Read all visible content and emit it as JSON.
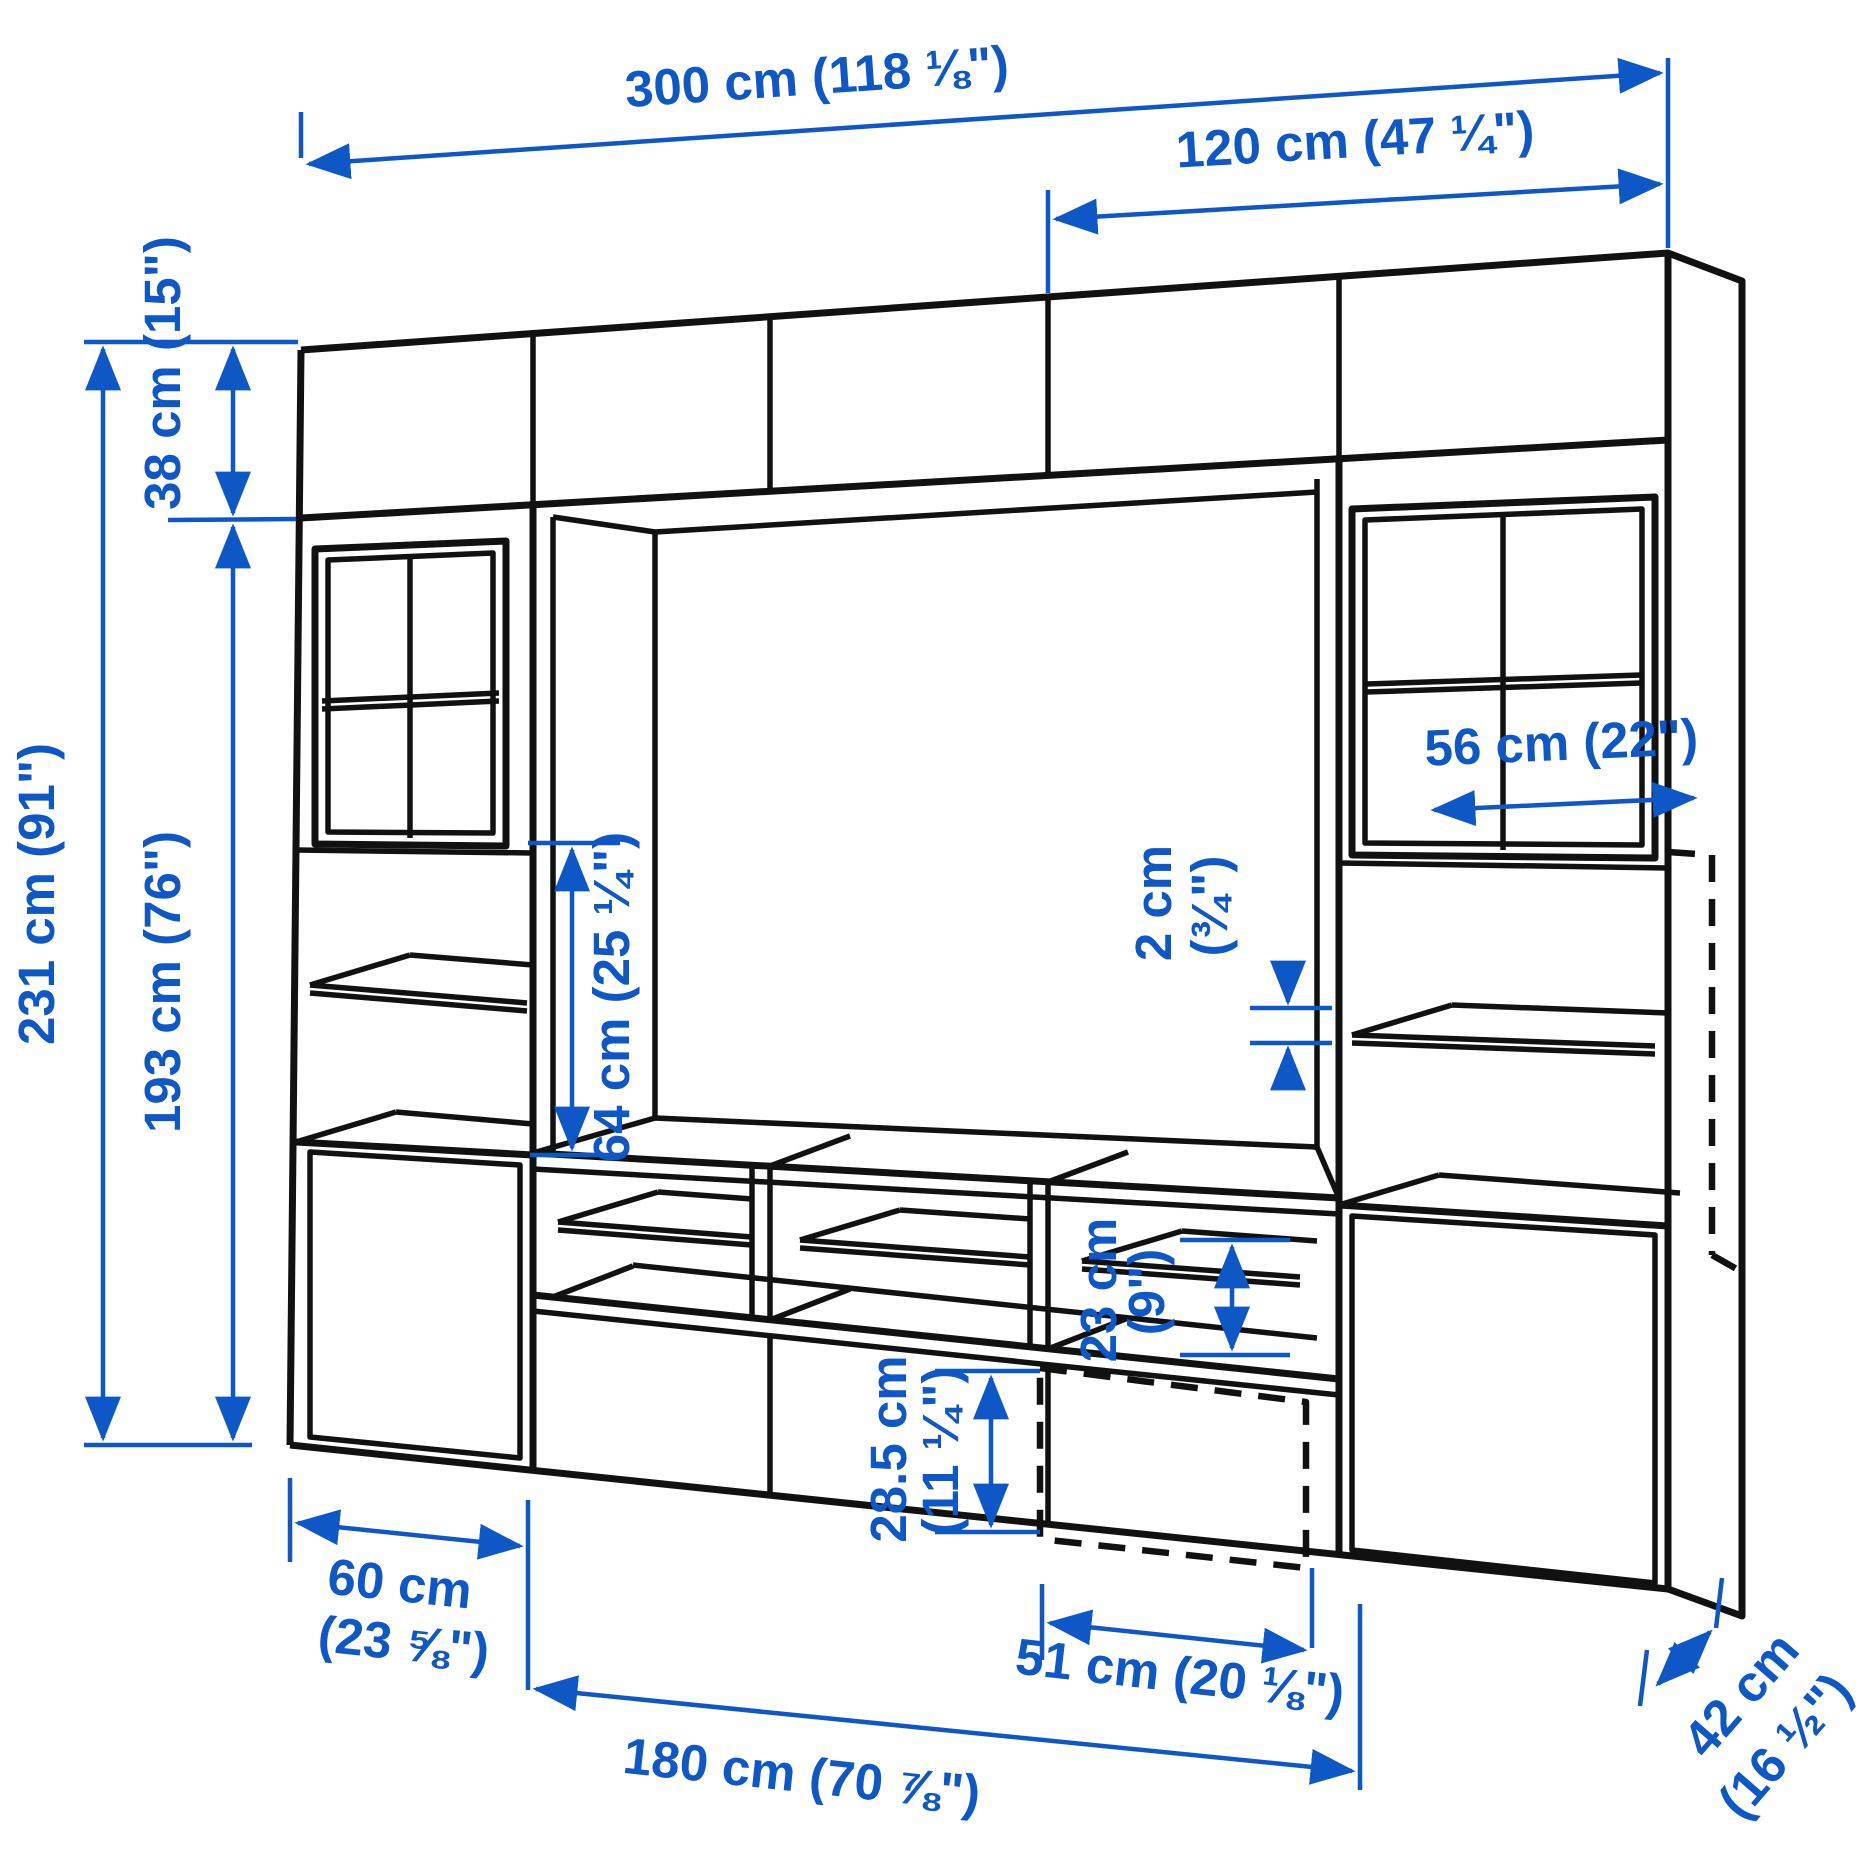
{
  "diagram": {
    "type": "furniture-dimension-diagram",
    "subject": "TV storage combination wall unit with glass doors and drawers",
    "line_color": "#111111",
    "accent_color": "#0e57c7",
    "labels": {
      "overall_width": "300 cm (118 ⅛\")",
      "upper_right_width": "120 cm (47 ¼\")",
      "top_cabinet_height": "38 cm (15\")",
      "total_height": "231 cm (91\")",
      "column_height": "193 cm (76\")",
      "tv_opening_height": "64 cm (25 ¼\")",
      "interior_width": "56 cm (22\")",
      "shelf_thickness_cm": "2 cm",
      "shelf_thickness_in": "(¾\")",
      "shelf_spacing_cm": "23 cm",
      "shelf_spacing_in": "(9\")",
      "drawer_height_cm": "28.5 cm",
      "drawer_height_in": "(11 ¼\")",
      "side_unit_width_cm": "60 cm",
      "side_unit_width_in": "(23 ⅝\")",
      "drawer_width": "51 cm (20 ⅛\")",
      "bench_width": "180 cm (70 ⅞\")",
      "depth_cm": "42 cm",
      "depth_in": "(16 ½\")"
    }
  }
}
